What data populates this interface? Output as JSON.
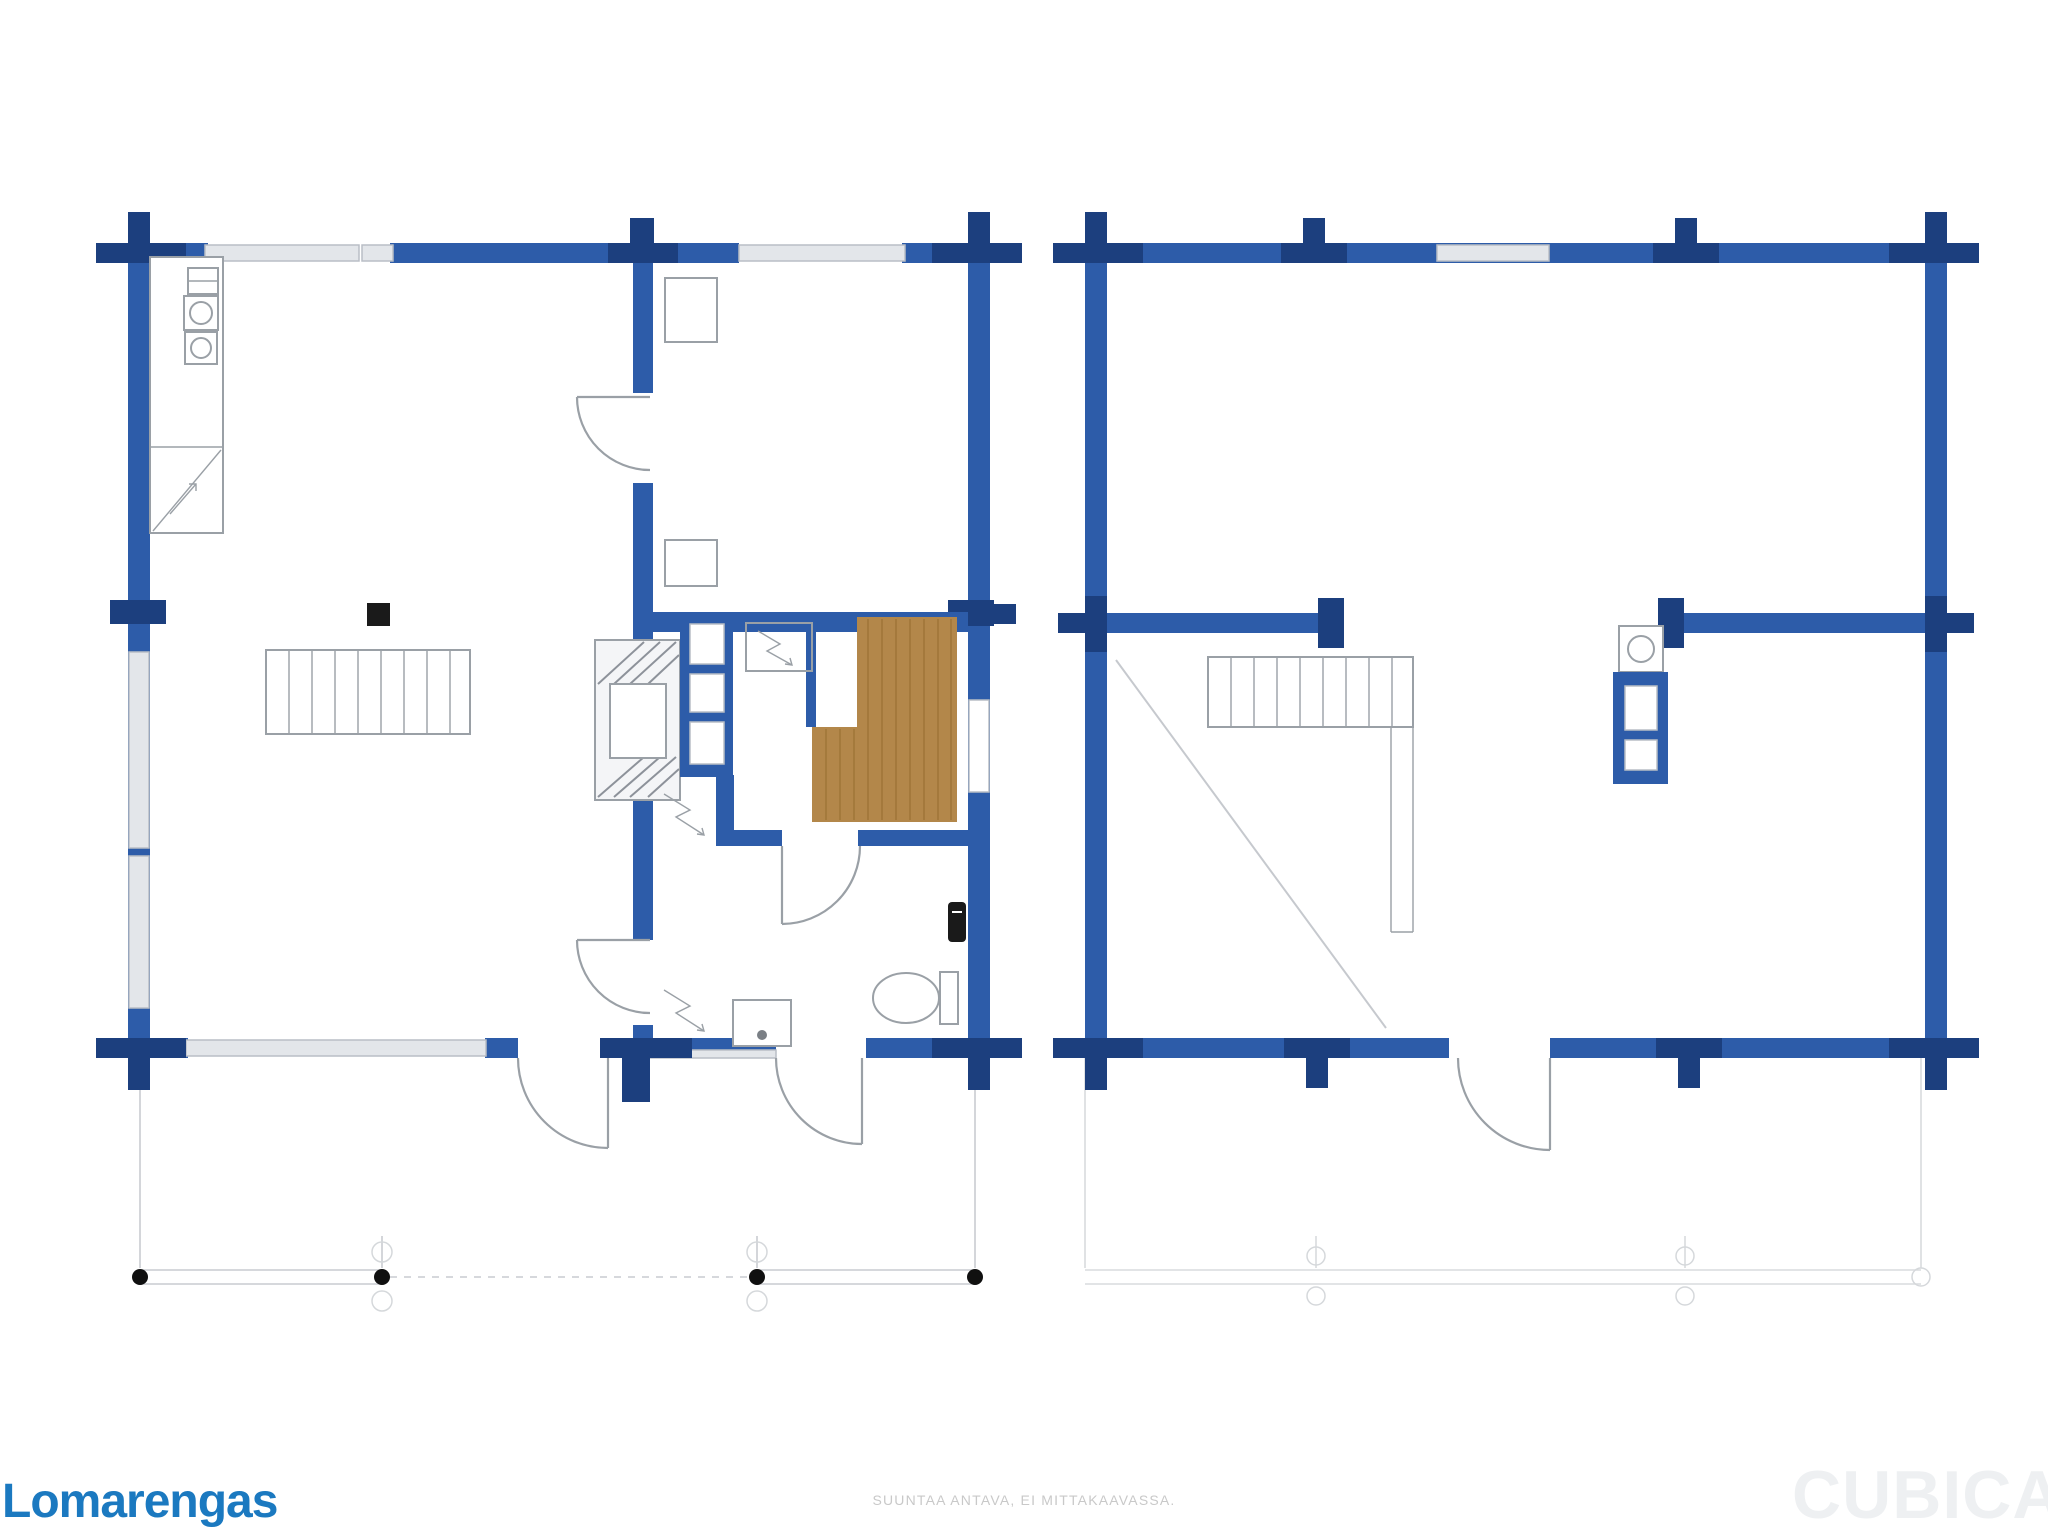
{
  "branding": {
    "logo_text": "Lomarengas",
    "watermark_text": "CUBICASA"
  },
  "footer": {
    "note": "SUUNTAA ANTAVA, EI MITTAKAAVASSA."
  },
  "plans": [
    {
      "id": "floor-1",
      "name": "ground-floor-plan"
    },
    {
      "id": "floor-2",
      "name": "upper-floor-plan"
    }
  ],
  "theme": {
    "wall": "#2d5ca9",
    "wall-dark": "#1c3f7e",
    "window-fill": "#e3e6ea",
    "window-stroke": "#b9bec6",
    "line": "#9aa0a6",
    "line-light": "#c6c9ce",
    "hatch": "#8d929a",
    "wood": "#b3874a",
    "wood-line": "#9f7538",
    "fixture-dark": "#1a1a1a",
    "logo": "#1b79c0",
    "note": "#c9c9c9",
    "watermark": "#eef0f2"
  }
}
